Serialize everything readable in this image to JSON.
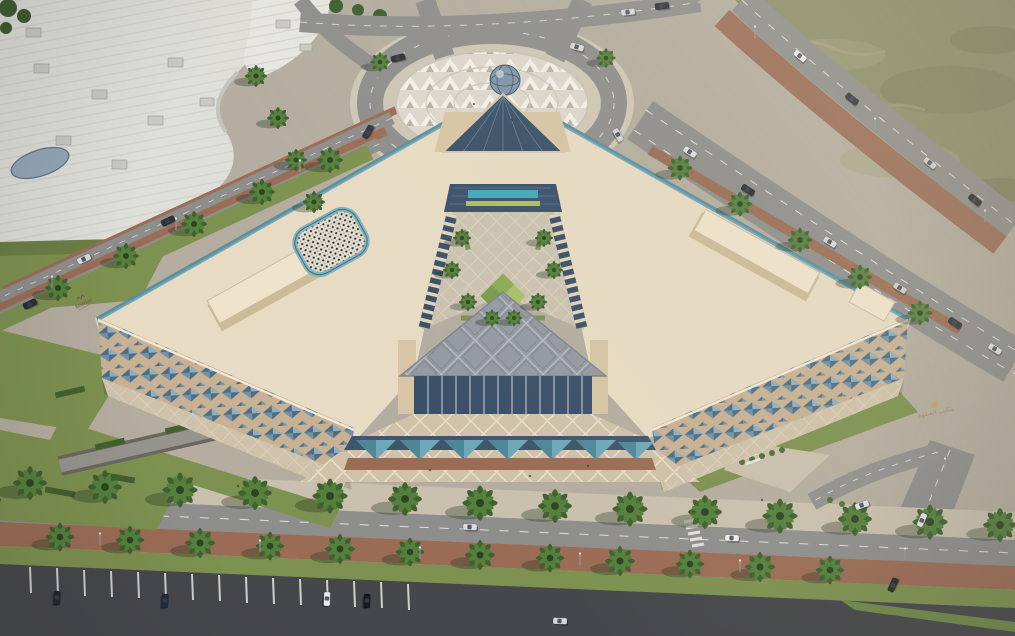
{
  "scene": {
    "signs": {
      "marriott": "Marriott",
      "office_arabic": "مكتب الصفوة"
    },
    "colors": {
      "cream": "#e7dcc3",
      "creamL": "#f2e8d4",
      "creamD": "#d7c5a5",
      "facBlue": "#6f92a8",
      "facBlueL": "#8fb0c2",
      "facBlueD": "#4e6d83",
      "facTan": "#c9b193",
      "glass": "#3a5068",
      "glassL": "#5c7a96",
      "pool": "#3fa9ba",
      "algae": "#a9bf62",
      "canopy": "#949aa2",
      "canopyL": "#b8bdc4",
      "canopyD": "#767c84",
      "teal": "#6fa8ba",
      "tealD": "#4f8799",
      "road": "#8e8e8c",
      "roadD": "#46474a",
      "lane": "#f2f2ee",
      "brick": "#9b6c55",
      "lawn": "#7d9150",
      "grassBright": "#7fae4e",
      "hedge": "#44602f",
      "palm1": "#3f6030",
      "palm2": "#54803c",
      "field": "#8d8f6a",
      "ground": "#b5aea0",
      "walk": "#c9c0ad",
      "plaza": "#ddd8cc",
      "plazaW": "#f4f1e9",
      "plazaG": "#b8b3a6",
      "white1": "#dfdfd9",
      "white2": "#e7e7e1",
      "mosTeal": "#7fb3c0"
    }
  }
}
